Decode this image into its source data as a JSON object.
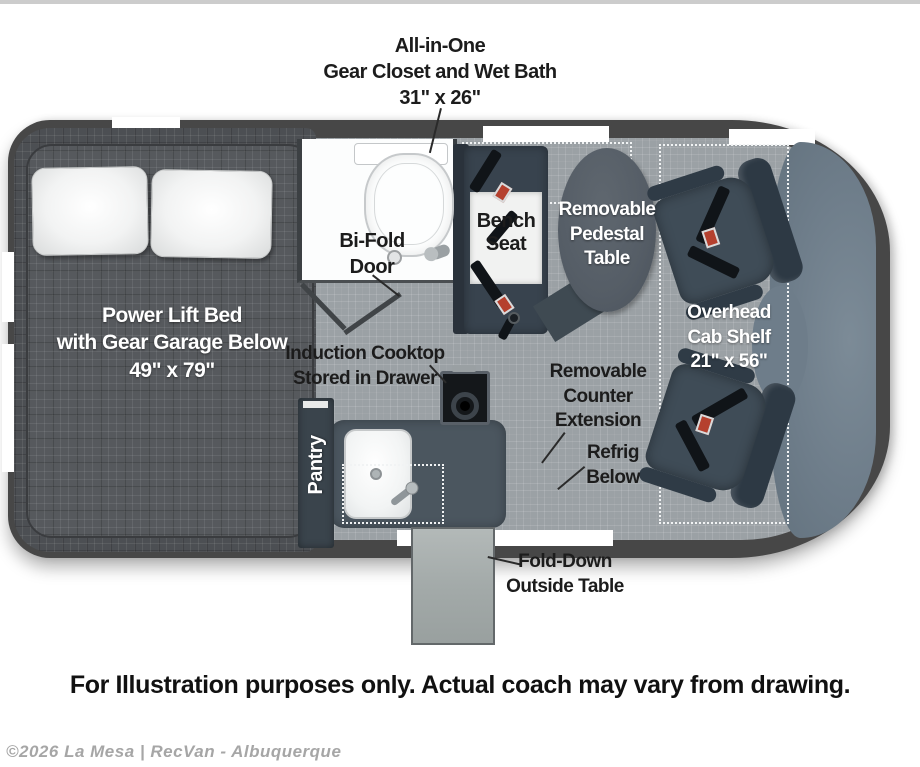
{
  "callouts": {
    "gear_closet": [
      "All-in-One",
      "Gear Closet and Wet Bath",
      "31\" x 26\""
    ],
    "bed": [
      "Power Lift Bed",
      "with Gear Garage Below",
      "49\" x 79\""
    ],
    "bifold_door": [
      "Bi-Fold",
      "Door"
    ],
    "bench_seat": [
      "Bench",
      "Seat"
    ],
    "pedestal_table": [
      "Removable",
      "Pedestal",
      "Table"
    ],
    "overhead_cab_shelf": [
      "Overhead",
      "Cab Shelf",
      "21\" x 56\""
    ],
    "induction_cooktop": [
      "Induction Cooktop",
      "Stored in Drawer"
    ],
    "pantry": "Pantry",
    "counter_extension": [
      "Removable",
      "Counter",
      "Extension"
    ],
    "refrig_below": [
      "Refrig",
      "Below"
    ],
    "fold_down_table": [
      "Fold-Down",
      "Outside Table"
    ]
  },
  "footer": {
    "disclaimer": "For Illustration purposes only.  Actual coach may vary from drawing.",
    "watermark": "©2026 La Mesa | RecVan - Albuquerque"
  },
  "colors": {
    "van_body": "#474747",
    "floor": "#9ba1a5",
    "bed_fabric": "#56595d",
    "furniture_slate": "#38434e",
    "pedestal_table": "#555d66",
    "dashboard": "#6e7d8a",
    "wet_bath": "#fcfdfd",
    "seatbelt_buckle": "#b5402e",
    "label_dark": "#1c1c1c",
    "label_light": "#ffffff",
    "watermark": "#a6a6a6"
  }
}
